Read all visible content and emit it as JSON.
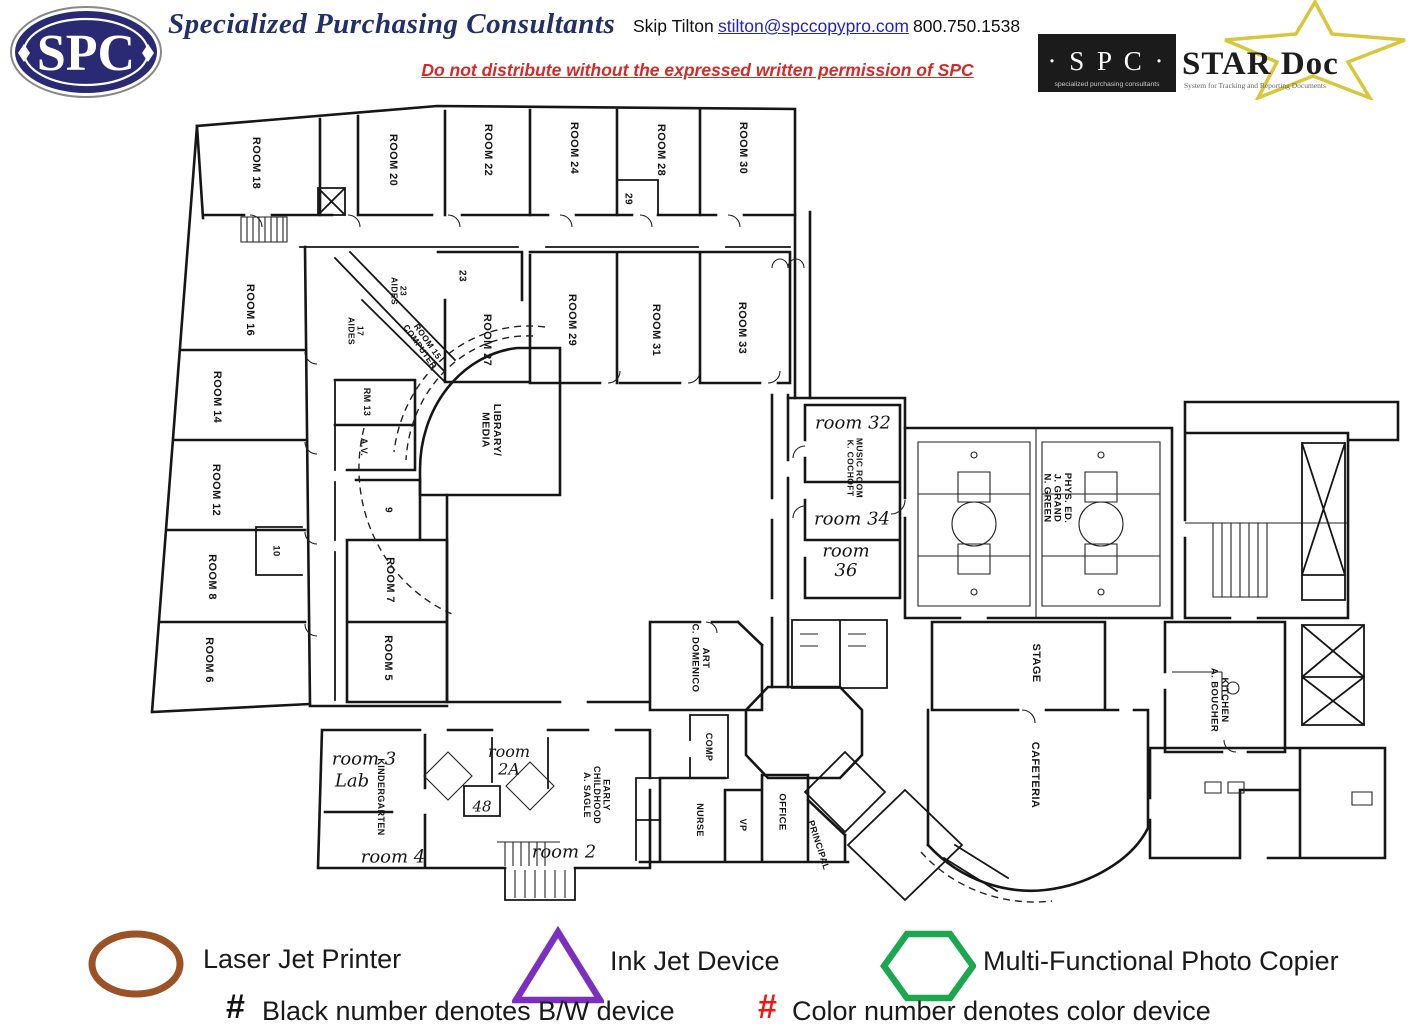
{
  "header": {
    "logo_text": "SPC",
    "company": "Specialized Purchasing Consultants",
    "contact_name": "Skip Tilton",
    "email": "stilton@spccopypro.com",
    "phone": "800.750.1538",
    "notice": "Do not distribute without the expressed written permission of SPC",
    "stardoc": {
      "spc": "· S P C ·",
      "spc_sub": "specialized purchasing consultants",
      "title": "STAR Doc",
      "subtitle": "System for Tracking and Reporting Documents",
      "star_color": "#d9c63c",
      "box_color": "#1b1b1b"
    },
    "logo_color": "#2a2973"
  },
  "floorplan": {
    "rooms": [
      {
        "label": "ROOM 18",
        "x": 257,
        "y": 163,
        "rot": 90
      },
      {
        "label": "ROOM 20",
        "x": 394,
        "y": 160,
        "rot": 90
      },
      {
        "label": "ROOM 22",
        "x": 489,
        "y": 150,
        "rot": 90
      },
      {
        "label": "ROOM 24",
        "x": 575,
        "y": 148,
        "rot": 90
      },
      {
        "label": "ROOM 28",
        "x": 662,
        "y": 150,
        "rot": 90
      },
      {
        "label": "ROOM 30",
        "x": 744,
        "y": 148,
        "rot": 90
      },
      {
        "label": "29",
        "x": 629,
        "y": 199,
        "rot": 90,
        "fs": 10
      },
      {
        "label": "23",
        "x": 463,
        "y": 276,
        "rot": 90,
        "fs": 10
      },
      {
        "label": "23\nAIDES",
        "x": 399,
        "y": 291,
        "rot": 90,
        "fs": 8.5
      },
      {
        "label": "17\nAIDES",
        "x": 356,
        "y": 331,
        "rot": 90,
        "fs": 8.5
      },
      {
        "label": "ROOM 15\nCOMPUTER",
        "x": 424,
        "y": 344,
        "rot": 55,
        "fs": 8.5
      },
      {
        "label": "ROOM 27",
        "x": 488,
        "y": 340,
        "rot": 90
      },
      {
        "label": "ROOM 29",
        "x": 573,
        "y": 320,
        "rot": 90
      },
      {
        "label": "ROOM 31",
        "x": 657,
        "y": 330,
        "rot": 90
      },
      {
        "label": "ROOM 33",
        "x": 743,
        "y": 328,
        "rot": 90
      },
      {
        "label": "ROOM 16",
        "x": 251,
        "y": 310,
        "rot": 90
      },
      {
        "label": "ROOM 14",
        "x": 218,
        "y": 397,
        "rot": 90
      },
      {
        "label": "ROOM 12",
        "x": 217,
        "y": 490,
        "rot": 90
      },
      {
        "label": "ROOM 8",
        "x": 213,
        "y": 577,
        "rot": 90
      },
      {
        "label": "ROOM 6",
        "x": 210,
        "y": 660,
        "rot": 90
      },
      {
        "label": "10",
        "x": 277,
        "y": 551,
        "rot": 90,
        "fs": 9.5
      },
      {
        "label": "RM 13",
        "x": 367,
        "y": 402,
        "rot": 90,
        "fs": 9
      },
      {
        "label": "A.V.",
        "x": 364,
        "y": 447,
        "rot": 90,
        "fs": 9
      },
      {
        "label": "9",
        "x": 389,
        "y": 510,
        "rot": 90,
        "fs": 10
      },
      {
        "label": "ROOM 7",
        "x": 391,
        "y": 580,
        "rot": 90
      },
      {
        "label": "ROOM 5",
        "x": 389,
        "y": 658,
        "rot": 90
      },
      {
        "label": "LIBRARY/\nMEDIA",
        "x": 492,
        "y": 430,
        "rot": 90,
        "fs": 10.5
      },
      {
        "label": "MUSIC ROOM\nK. COCHOFT",
        "x": 855,
        "y": 468,
        "rot": 90,
        "fs": 8.5
      },
      {
        "label": "PHYS. ED.\nJ. GRAND\nN. GREEN",
        "x": 1058,
        "y": 498,
        "rot": 90,
        "fs": 9.5
      },
      {
        "label": "STAGE",
        "x": 1037,
        "y": 663,
        "rot": 90
      },
      {
        "label": "CAFETERIA",
        "x": 1036,
        "y": 775,
        "rot": 90
      },
      {
        "label": "KITCHEN\nA. BOUCHER",
        "x": 1220,
        "y": 700,
        "rot": 90,
        "fs": 9.5
      },
      {
        "label": "ART\nC. DOMENICO",
        "x": 701,
        "y": 658,
        "rot": 90,
        "fs": 9.5
      },
      {
        "label": "COMP",
        "x": 709,
        "y": 747,
        "rot": 90,
        "fs": 9
      },
      {
        "label": "NURSE",
        "x": 700,
        "y": 820,
        "rot": 90,
        "fs": 9
      },
      {
        "label": "VP",
        "x": 743,
        "y": 825,
        "rot": 90,
        "fs": 9
      },
      {
        "label": "OFFICE",
        "x": 783,
        "y": 812,
        "rot": 90,
        "fs": 9.5
      },
      {
        "label": "PRINCIPAL",
        "x": 819,
        "y": 845,
        "rot": 72,
        "fs": 9
      },
      {
        "label": "KINDERGARTEN",
        "x": 381,
        "y": 797,
        "rot": 90,
        "fs": 9
      },
      {
        "label": "EARLY\nCHILDHOOD\nA. SAGLE",
        "x": 597,
        "y": 795,
        "rot": 90,
        "fs": 9
      },
      {
        "label": "room 32",
        "x": 853,
        "y": 422,
        "style": "hand",
        "fs": 18
      },
      {
        "label": "room 34",
        "x": 852,
        "y": 518,
        "style": "hand",
        "fs": 18
      },
      {
        "label": "room\n36",
        "x": 846,
        "y": 560,
        "style": "hand",
        "fs": 18
      },
      {
        "label": "room 3",
        "x": 364,
        "y": 758,
        "style": "hand",
        "fs": 18
      },
      {
        "label": "Lab",
        "x": 352,
        "y": 780,
        "style": "hand",
        "fs": 18
      },
      {
        "label": "room 4",
        "x": 393,
        "y": 856,
        "style": "hand",
        "fs": 18
      },
      {
        "label": "room\n2A",
        "x": 509,
        "y": 760,
        "style": "hand",
        "fs": 16
      },
      {
        "label": "room 2",
        "x": 564,
        "y": 851,
        "style": "hand",
        "fs": 18
      },
      {
        "label": "48",
        "x": 482,
        "y": 806,
        "style": "hand",
        "fs": 15
      }
    ]
  },
  "legend": {
    "items": [
      {
        "shape": "ellipse",
        "color": "#9a5226",
        "label": "Laser Jet Printer"
      },
      {
        "shape": "triangle",
        "color": "#7b2fbf",
        "label": "Ink Jet Device"
      },
      {
        "shape": "hexagon",
        "color": "#1ca74f",
        "label": "Multi-Functional Photo Copier"
      }
    ],
    "notes": [
      {
        "symbol": "#",
        "color": "#111111",
        "label": "Black number denotes B/W device"
      },
      {
        "symbol": "#",
        "color": "#f51515",
        "label": "Color number denotes color device"
      }
    ]
  }
}
